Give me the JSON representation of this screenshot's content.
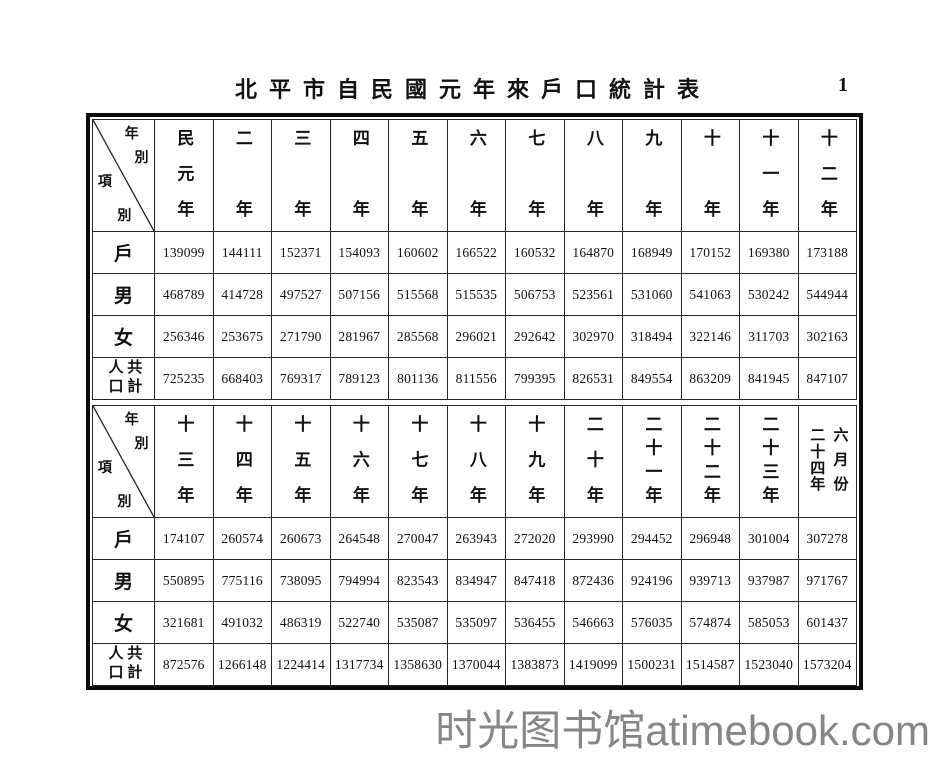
{
  "page": {
    "title": "北平市自民國元年來戶口統計表",
    "page_number": "1",
    "watermark": "时光图书馆atimebook.com"
  },
  "table": {
    "corner": {
      "c1": "年",
      "c2": "別",
      "c3": "項",
      "c4": "別"
    },
    "sections": [
      {
        "years": [
          "民元年",
          "二年",
          "三年",
          "四年",
          "五年",
          "六年",
          "七年",
          "八年",
          "九年",
          "十年",
          "十一年",
          "十二年"
        ],
        "rows": [
          {
            "label": "戶",
            "values": [
              "139099",
              "144111",
              "152371",
              "154093",
              "160602",
              "166522",
              "160532",
              "164870",
              "168949",
              "170152",
              "169380",
              "173188"
            ]
          },
          {
            "label": "男",
            "values": [
              "468789",
              "414728",
              "497527",
              "507156",
              "515568",
              "515535",
              "506753",
              "523561",
              "531060",
              "541063",
              "530242",
              "544944"
            ]
          },
          {
            "label": "女",
            "values": [
              "256346",
              "253675",
              "271790",
              "281967",
              "285568",
              "296021",
              "292642",
              "302970",
              "318494",
              "322146",
              "311703",
              "302163"
            ]
          },
          {
            "label": "人口共計",
            "values": [
              "725235",
              "668403",
              "769317",
              "789123",
              "801136",
              "811556",
              "799395",
              "826531",
              "849554",
              "863209",
              "841945",
              "847107"
            ]
          }
        ]
      },
      {
        "years": [
          "十三年",
          "十四年",
          "十五年",
          "十六年",
          "十七年",
          "十八年",
          "十九年",
          "二十年",
          "二十一年",
          "二十二年",
          "二十三年",
          "二十四年六月份"
        ],
        "rows": [
          {
            "label": "戶",
            "values": [
              "174107",
              "260574",
              "260673",
              "264548",
              "270047",
              "263943",
              "272020",
              "293990",
              "294452",
              "296948",
              "301004",
              "307278"
            ]
          },
          {
            "label": "男",
            "values": [
              "550895",
              "775116",
              "738095",
              "794994",
              "823543",
              "834947",
              "847418",
              "872436",
              "924196",
              "939713",
              "937987",
              "971767"
            ]
          },
          {
            "label": "女",
            "values": [
              "321681",
              "491032",
              "486319",
              "522740",
              "535087",
              "535097",
              "536455",
              "546663",
              "576035",
              "574874",
              "585053",
              "601437"
            ]
          },
          {
            "label": "人口共計",
            "values": [
              "872576",
              "1266148",
              "1224414",
              "1317734",
              "1358630",
              "1370044",
              "1383873",
              "1419099",
              "1500231",
              "1514587",
              "1523040",
              "1573204"
            ]
          }
        ]
      }
    ]
  }
}
